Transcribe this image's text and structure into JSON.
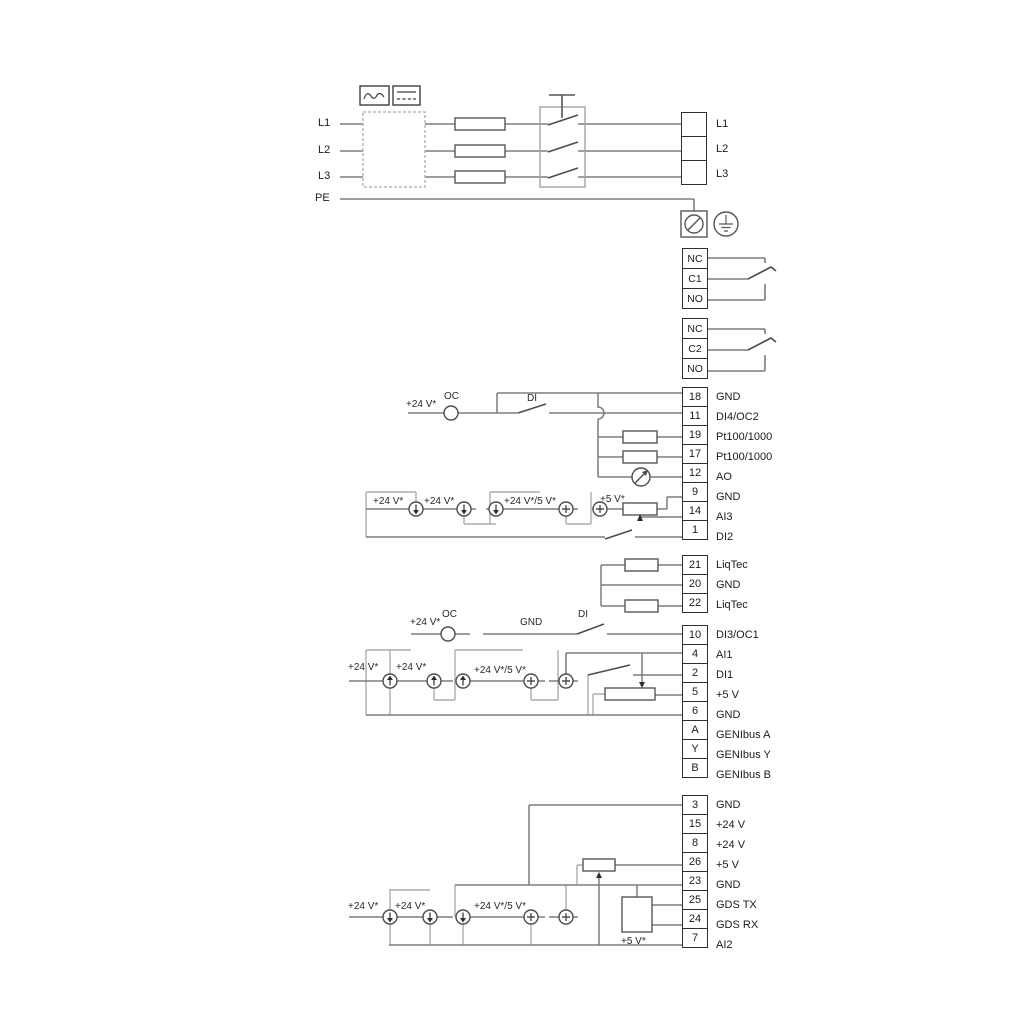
{
  "power": {
    "left": [
      "L1",
      "L2",
      "L3",
      "PE"
    ],
    "right": [
      "L1",
      "L2",
      "L3"
    ]
  },
  "relays": {
    "r1": [
      "NC",
      "C1",
      "NO"
    ],
    "r2": [
      "NC",
      "C2",
      "NO"
    ]
  },
  "strips": {
    "a": {
      "numbers": [
        "18",
        "11",
        "19",
        "17",
        "12",
        "9",
        "14",
        "1"
      ],
      "labels": [
        "GND",
        "DI4/OC2",
        "Pt100/1000",
        "Pt100/1000",
        "AO",
        "GND",
        "AI3",
        "DI2"
      ]
    },
    "b": {
      "numbers": [
        "21",
        "20",
        "22"
      ],
      "labels": [
        "LiqTec",
        "GND",
        "LiqTec"
      ]
    },
    "c": {
      "numbers": [
        "10",
        "4",
        "2",
        "5",
        "6",
        "A",
        "Y",
        "B"
      ],
      "labels": [
        "DI3/OC1",
        "AI1",
        "DI1",
        "+5 V",
        "GND",
        "GENIbus A",
        "GENIbus Y",
        "GENIbus B"
      ]
    },
    "d": {
      "numbers": [
        "3",
        "15",
        "8",
        "26",
        "23",
        "25",
        "24",
        "7"
      ],
      "labels": [
        "GND",
        "+24 V",
        "+24 V",
        "+5 V",
        "GND",
        "GDS TX",
        "GDS RX",
        "AI2"
      ]
    }
  },
  "floating": {
    "oc2": {
      "v24": "+24 V*",
      "oc": "OC",
      "di": "DI"
    },
    "m1": {
      "a": "+24 V*",
      "b": "+24 V*",
      "c": "+24 V*/5 V*",
      "d": "+5 V*"
    },
    "oc1": {
      "v24": "+24 V*",
      "oc": "OC",
      "gnd": "GND",
      "di": "DI"
    },
    "m2": {
      "a": "+24 V*",
      "b": "+24 V*",
      "c": "+24 V*/5 V*"
    },
    "m3": {
      "a": "+24 V*",
      "b": "+24 V*",
      "c": "+24 V*/5 V*",
      "d": "+5 V*"
    }
  },
  "colors": {
    "wire": "#7a7d80",
    "light_rail": "#aaadb0",
    "component": "#54575a",
    "box_border": "#2f2f2f"
  }
}
